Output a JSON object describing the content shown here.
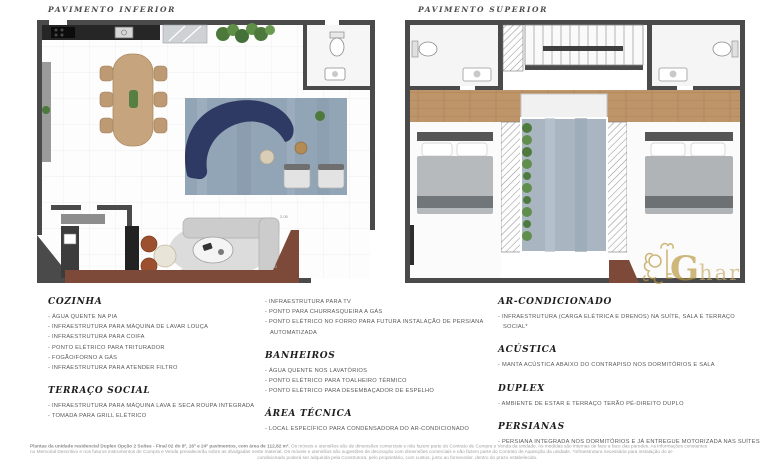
{
  "plans": {
    "left_title": "PAVIMENTO INFERIOR",
    "right_title": "PAVIMENTO SUPERIOR",
    "dimension_labels": {
      "d1": "2.05",
      "d2": "6.10"
    }
  },
  "watermark": {
    "g": "G",
    "rest": "har"
  },
  "columns": [
    {
      "sections": [
        {
          "heading": "COZINHA",
          "items": [
            "- ÁGUA QUENTE NA PIA",
            "- INFRAESTRUTURA PARA MÁQUINA DE LAVAR LOUÇA",
            "- INFRAESTRUTURA PARA COIFA",
            "- PONTO ELÉTRICO PARA TRITURADOR",
            "- FOGÃO/FORNO A GÁS",
            "- INFRAESTRUTURA PARA ATENDER FILTRO"
          ]
        },
        {
          "heading": "TERRAÇO SOCIAL",
          "items": [
            "- INFRAESTRUTURA PARA MÁQUINA LAVA E SECA ROUPA INTEGRADA",
            "- TOMADA PARA GRILL ELÉTRICO"
          ]
        }
      ]
    },
    {
      "sections": [
        {
          "heading": "",
          "items": [
            "- INFRAESTRUTURA PARA TV",
            "- PONTO PARA CHURRASQUEIRA A GÁS",
            "- PONTO ELÉTRICO NO FORRO PARA FUTURA INSTALAÇÃO DE PERSIANA AUTOMATIZADA"
          ]
        },
        {
          "heading": "BANHEIROS",
          "items": [
            "- ÁGUA QUENTE NOS LAVATÓRIOS",
            "- PONTO ELÉTRICO PARA TOALHEIRO TÉRMICO",
            "- PONTO ELÉTRICO PARA DESEMBAÇADOR DE ESPELHO"
          ]
        },
        {
          "heading": "ÁREA TÉCNICA",
          "items": [
            "- LOCAL ESPECÍFICO PARA CONDENSADORA DO AR-CONDICIONADO"
          ]
        }
      ]
    },
    {
      "sections": [
        {
          "heading": "AR-CONDICIONADO",
          "items": [
            "- INFRAESTRUTURA (CARGA ELÉTRICA E DRENOS) NA SUÍTE, SALA E TERRAÇO SOCIAL*"
          ]
        },
        {
          "heading": "ACÚSTICA",
          "items": [
            "- MANTA ACÚSTICA ABAIXO DO CONTRAPISO NOS DORMITÓRIOS E SALA"
          ]
        },
        {
          "heading": "DUPLEX",
          "items": [
            "- AMBIENTE DE ESTAR E TERRAÇO TERÃO PÉ-DIREITO DUPLO"
          ]
        },
        {
          "heading": "PERSIANAS",
          "items": [
            "- PERSIANA INTEGRADA NOS DORMITÓRIOS E JÁ ENTREGUE MOTORIZADA NAS SUÍTES"
          ]
        }
      ]
    }
  ],
  "disclaimer": {
    "intro_bold": "Plantas da unidade residencial Duplex Opção 2 Suítes - Final 02 do 8º, 16º e 24º pavimentos, com área de 112,82 m².",
    "line1_rest": " Os móveis e utensílios são de dimensões comerciais e não fazem parte do Contrato de Compra e Venda da unidade. As medidas são internas de face a face das paredes. As informações constantes",
    "line2": "no Memorial Descritivo e nos futuros instrumentos de Compra e Venda prevalecerão sobre as divulgadas neste material. Os móveis e utensílios são sugestões de decoração com dimensões comerciais e não fazem parte do Contrato de Aquisição da unidade. *Infraestrutura necessária para instalação do ar-",
    "line3": "condicionado poderá ser adquirida pela Construtora, pelo proprietário, com custos, junto ao fornecedor, dentro do prazo estabelecido."
  },
  "colors": {
    "wall": "#4a4a4a",
    "wood": "#bd9569",
    "navy_sofa": "#2e3a63",
    "rug_blue": "#92a5b6",
    "terrace_brown": "#7d4a39",
    "watermark_gold": "#b9973f"
  }
}
